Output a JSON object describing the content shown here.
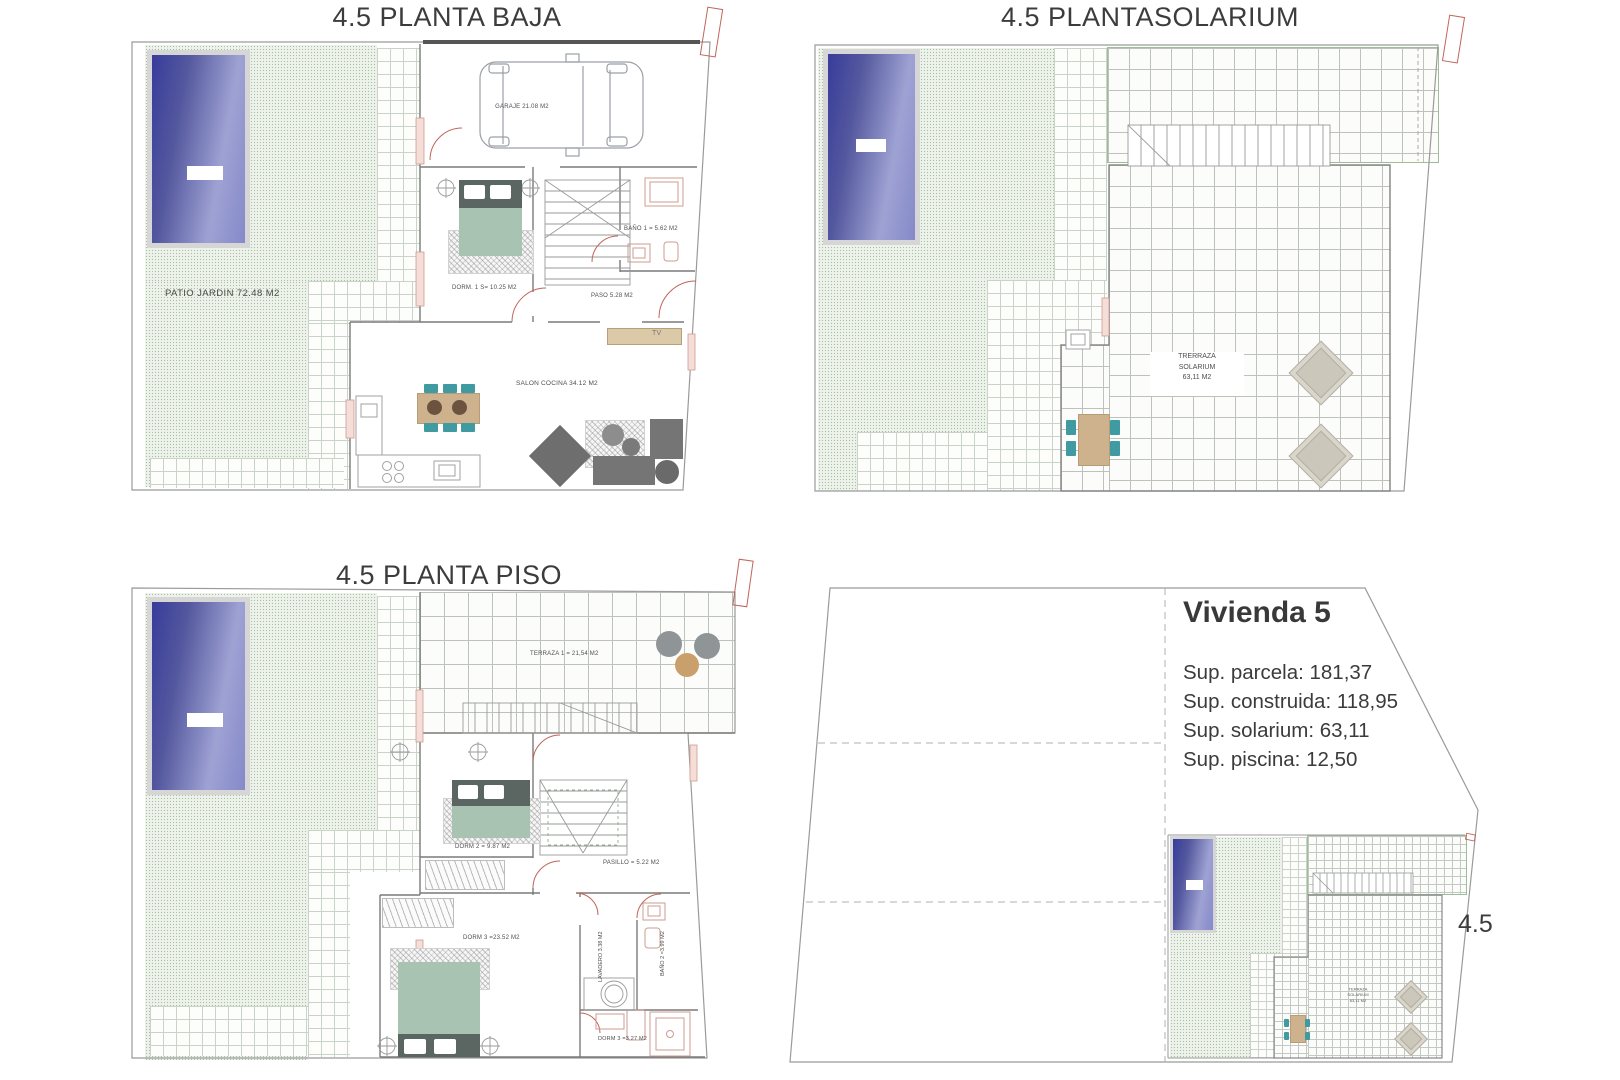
{
  "titles": {
    "planta_baja": "4.5 PLANTA BAJA",
    "solarium": "4.5 PLANTASOLARIUM",
    "planta_piso": "4.5 PLANTA PISO"
  },
  "planta_baja": {
    "patio_label": "PATIO JARDIN 72.48 M2",
    "garaje_label": "GARAJE 21.08 M2",
    "dorm1_label": "DORM. 1 S= 10.25 M2",
    "bano1_label": "BAÑO 1 =  5.62 M2",
    "paso_label": "PASO 5.28 M2",
    "salon_label": "SALON COCINA 34.12 M2",
    "tv_label": "TV"
  },
  "planta_solarium": {
    "terraza_label": "TRERRAZA\nSOLARIUM\n63,11 M2"
  },
  "planta_piso": {
    "terraza_label": "TERRAZA 1 = 21,54 M2",
    "dorm2_label": "DORM 2 = 9.87 M2",
    "pasillo_label": "PASILLO = 5.22 M2",
    "dorm3_label": "DORM 3 =23.52 M2",
    "lavadero_label": "LAVADERO 3.38 M2",
    "bano2_label": "BAÑO 2 =3.99 M2",
    "bano3_label": "DORM 3 =3.27 M2"
  },
  "vivienda": {
    "title": "Vivienda  5",
    "sup_parcela": "Sup. parcela: 181,37",
    "sup_construida": "Sup. construida: 118,95",
    "sup_solarium": "Sup. solarium: 63,11",
    "sup_piscina": "Sup. piscina: 12,50",
    "plot_label": "4.5",
    "mini_terraza_label": "TERRAZA\nSOLARIUM\n63,11 M2"
  },
  "colors": {
    "pool_dark": "#383c9b",
    "pool_light": "#9ea2d3",
    "garden_green": "#edf2ea",
    "bed_sage": "#a9c3b2",
    "chair_teal": "#3f9aa1",
    "table_tan": "#cdb28d",
    "accent_red": "#c0655c"
  }
}
